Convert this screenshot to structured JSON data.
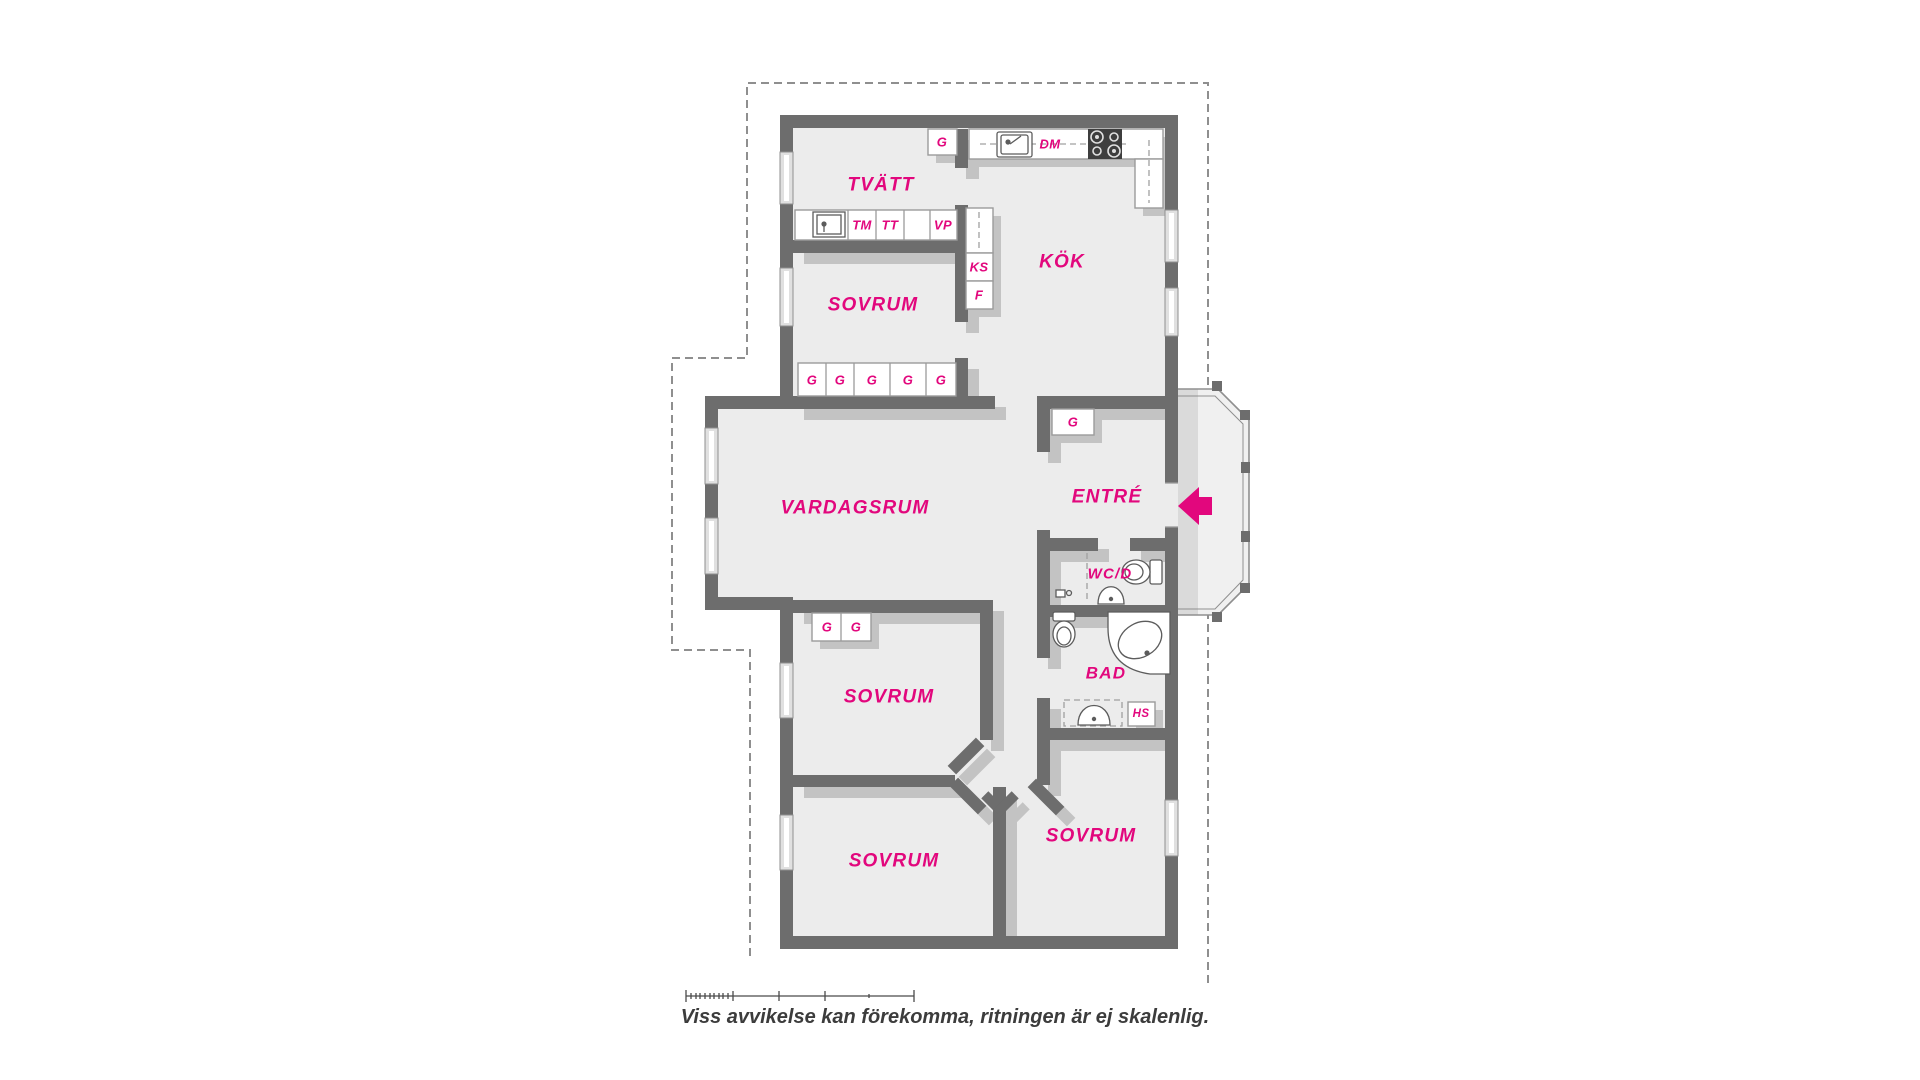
{
  "plan": {
    "rooms": {
      "tvatt": "TVÄTT",
      "kok": "KÖK",
      "sovrum_top": "SOVRUM",
      "vardagsrum": "VARDAGSRUM",
      "entre": "ENTRÉ",
      "wcd": "WC/D",
      "bad": "BAD",
      "sovrum_mid": "SOVRUM",
      "sovrum_bottom_left": "SOVRUM",
      "sovrum_bottom_right": "SOVRUM"
    },
    "units": {
      "wardrobe": "G",
      "washing_machine": "TM",
      "dryer": "TT",
      "water_heater": "VP",
      "fridge": "KS",
      "freezer": "F",
      "dishwasher": "DM",
      "tall_cabinet": "HS"
    }
  },
  "footer": {
    "disclaimer": "Viss avvikelse kan förekomma, ritningen är ej skalenlig."
  },
  "colors": {
    "accent": "#e2077d",
    "wall": "#6d6d6d",
    "floor": "#ececec",
    "shadow": "#c3c3c3",
    "caption": "#3c3c3c"
  }
}
